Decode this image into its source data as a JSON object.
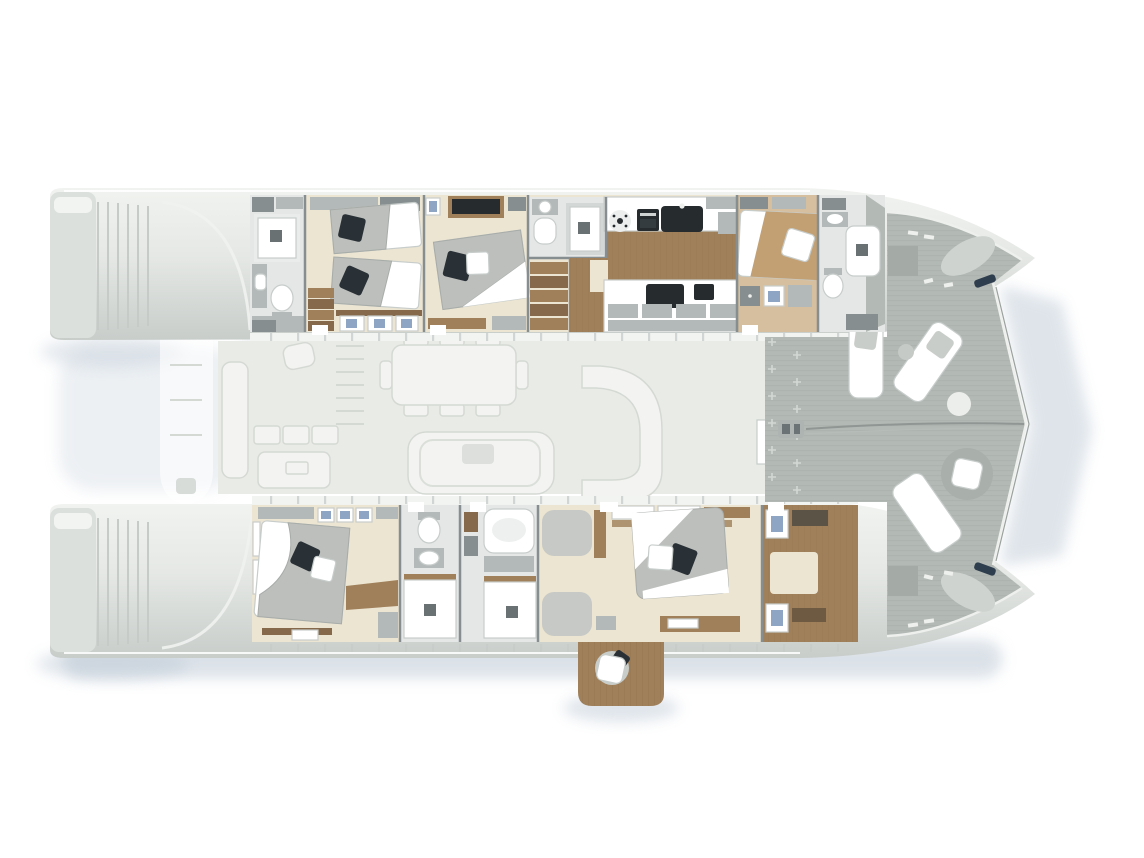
{
  "diagram": {
    "kind": "yacht-deck-plan",
    "vessel_type": "sailing catamaran",
    "orientation": "bow-right",
    "decks_shown": [
      "lower-deck cabins (rendered)",
      "main deck saloon & cockpit (ghosted)"
    ]
  },
  "port_hull": {
    "rooms": [
      {
        "name": "aft-bathroom",
        "features": [
          "shower",
          "vanity-washbasin",
          "toilet"
        ]
      },
      {
        "name": "twin-guest-cabin",
        "features": [
          "single-bed",
          "single-bed",
          "wardrobe",
          "entry-steps",
          "three-hull-windows"
        ]
      },
      {
        "name": "vip-double-cabin",
        "features": [
          "double-bed",
          "tv-cabinet",
          "shelf",
          "hull-window"
        ]
      },
      {
        "name": "ensuite-bathroom",
        "features": [
          "washbasin",
          "toilet",
          "shower"
        ]
      },
      {
        "name": "companionway-stairs",
        "features": [
          "five-steps-down"
        ]
      },
      {
        "name": "galley",
        "features": [
          "washing-machine",
          "oven",
          "double-sink",
          "refrigerator",
          "cooktop",
          "microwave",
          "cabinet-fronts"
        ]
      },
      {
        "name": "forward-guest-cabin",
        "features": [
          "double-bed",
          "front-load-washer",
          "window-locker",
          "hanging-locker"
        ]
      },
      {
        "name": "forward-bathroom",
        "features": [
          "washbasin",
          "toilet",
          "shower"
        ]
      }
    ]
  },
  "starboard_hull": {
    "rooms": [
      {
        "name": "aft-guest-cabin",
        "features": [
          "double-bed",
          "overhead-lockers",
          "three-hull-windows",
          "shelf"
        ]
      },
      {
        "name": "guest-bathroom",
        "features": [
          "toilet",
          "washbasin",
          "shower"
        ]
      },
      {
        "name": "master-bathroom",
        "features": [
          "storage-column",
          "bathtub",
          "counter",
          "shower"
        ]
      },
      {
        "name": "master-cabin",
        "features": [
          "king-bed",
          "chaise-seat",
          "chaise-seat",
          "shelf-unit",
          "windows",
          "vanity-desk"
        ]
      },
      {
        "name": "walk-in-wardrobe",
        "features": [
          "island-unit",
          "hanging-rail",
          "folded-clothes-shelf",
          "corner-lockers"
        ]
      },
      {
        "name": "fold-down-balcony",
        "features": [
          "teak-platform",
          "lounge-pouf"
        ]
      }
    ]
  },
  "main_deck_ghost": {
    "areas": [
      {
        "name": "aft-cockpit",
        "features": [
          "transom-bench",
          "seat-cushions",
          "cockpit-table",
          "helm-seat",
          "davits",
          "tender"
        ]
      },
      {
        "name": "saloon",
        "features": [
          "dining-table",
          "eight-chairs",
          "lounge-sofa",
          "coffee-table",
          "curved-bar",
          "flybridge-stairs",
          "foredeck-door"
        ]
      }
    ]
  },
  "foredeck": {
    "features": [
      "sun-lounger",
      "sun-lounger",
      "sun-lounger",
      "round-daybed",
      "pouf-table",
      "pouf",
      "deck-hatch",
      "deck-hatch",
      "windlass",
      "anchor-chain-line",
      "anchor-locker-port",
      "anchor-locker-starboard",
      "bow-cleat",
      "bow-cleat",
      "deck-fittings"
    ]
  },
  "stern": {
    "features": [
      "port-transom-steps",
      "starboard-transom-steps",
      "tender-platform"
    ]
  },
  "colors": {
    "white": "#ffffff",
    "hull_light": "#eef0ed",
    "deck_ghost": "#e9ebe7",
    "ghost_furniture": "#f3f4f1",
    "ghost_line": "#d5d9d4",
    "foredeck": "#b3b9b5",
    "foredeck_line": "#a5aba7",
    "wall": "#878e8f",
    "wall_light": "#b3b8b8",
    "floor_cream": "#ece5d2",
    "floor_marble": "#e4e7e6",
    "wood": "#a0805a",
    "wood_dark": "#86684a",
    "wood_light": "#c2a074",
    "appliance_dark": "#262b2e",
    "pillow_navy": "#2a3136",
    "duvet_gray": "#bcbfbc",
    "window_blue": "#8ea6c4",
    "shadow_blue": "#b8c5d2",
    "fitting_navy": "#2f3e4e"
  }
}
